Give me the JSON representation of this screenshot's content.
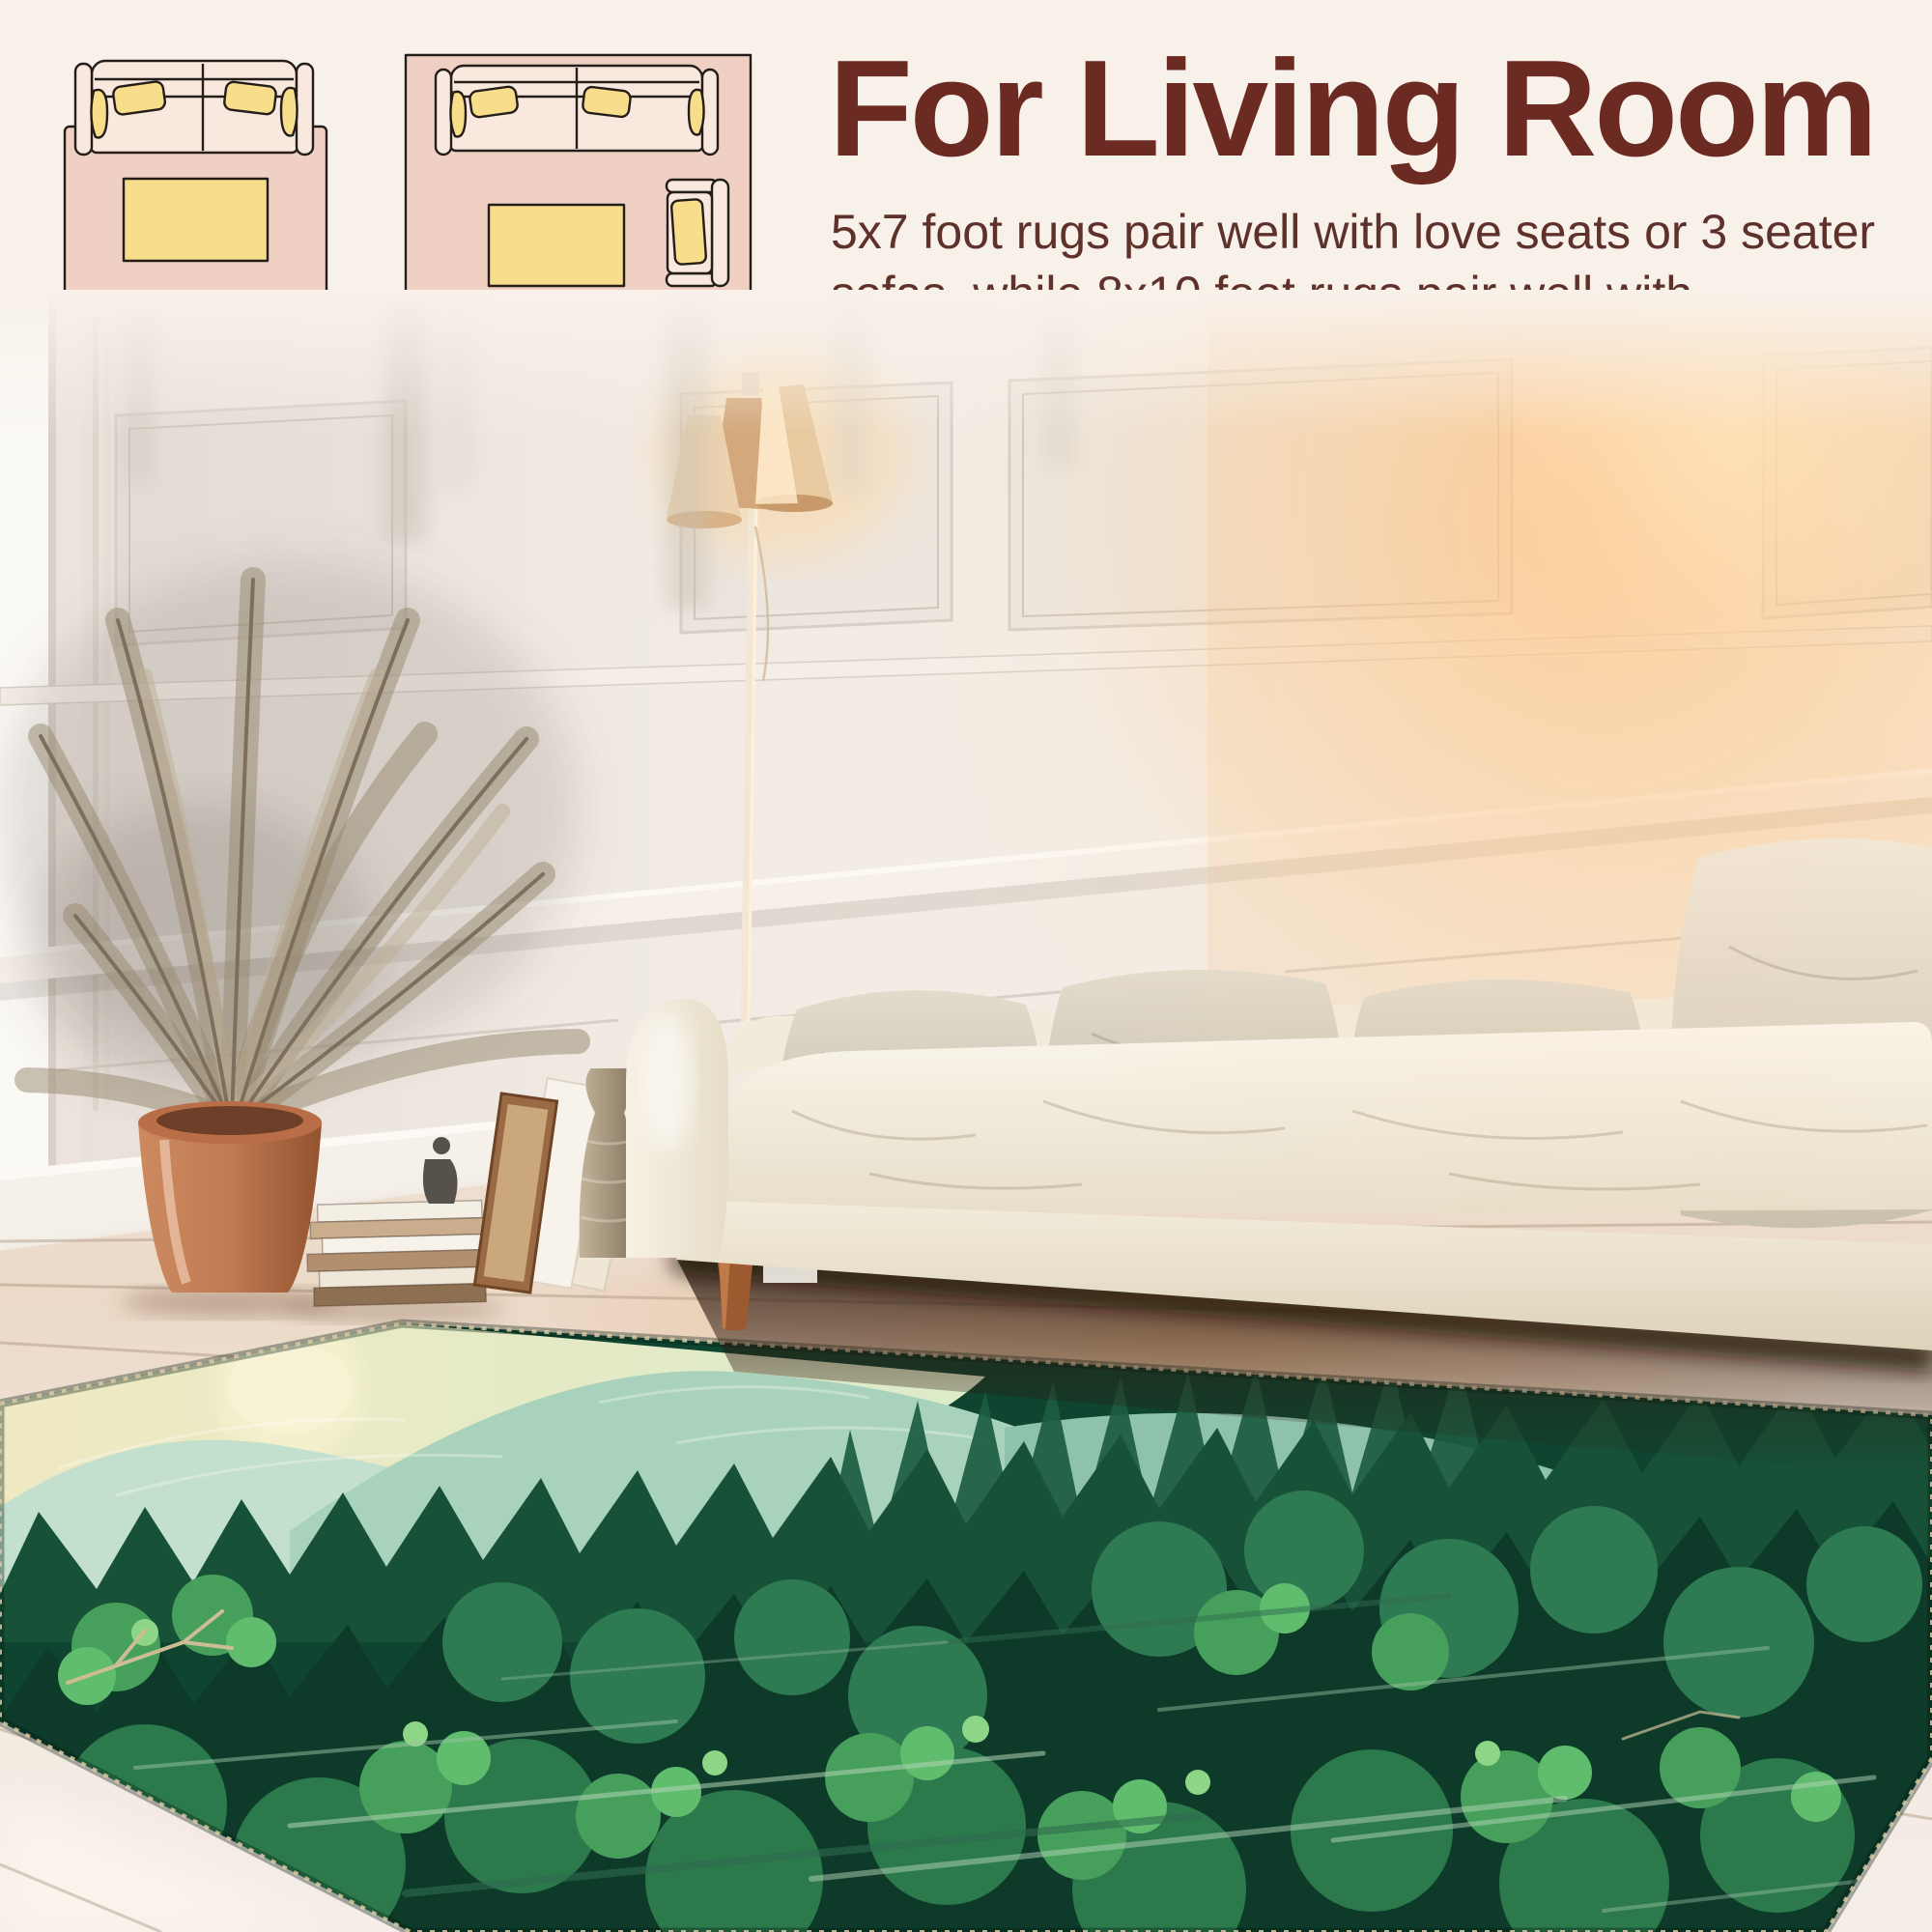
{
  "header": {
    "title": "For Living Room",
    "body_line1": "5x7 foot rugs pair well with love seats or 3 seater",
    "body_line2": "sofas, while 8x10 foot rugs pair well with sectionals."
  },
  "diagrams": {
    "small_label": "5x7",
    "large_label": "8x10"
  },
  "palette": {
    "bg": "#f8f1ea",
    "heading": "#6b2a22",
    "body": "#5e312a",
    "dg-outline": "#241e1a",
    "dg-rug": "#f0d0c2",
    "dg-sofa": "#f9e8de",
    "dg-pillow": "#f8dd8a",
    "dg-label": "#6d5a49",
    "room-wall": "#f1ebe4",
    "room-sofa": "#f4eee2",
    "room-pillow": "#d8d0c1",
    "room-pot": "#c07a52",
    "room-shade": "#e8c9a0",
    "room-leg": "#9c5a30",
    "floor-pale": "#f2e8e0",
    "floor-warm": "#e5c19b",
    "rug-base": "#0f4430",
    "rug-sky": "#efe9c2",
    "rug-sun": "#f8f3d4",
    "rug-mountain": "#a9d2bc",
    "rug-pine-dark": "#175138",
    "rug-pine-mid": "#2e7a52",
    "rug-leaf": "#5fbd6d",
    "rug-trunk": "#b3d4b6"
  }
}
